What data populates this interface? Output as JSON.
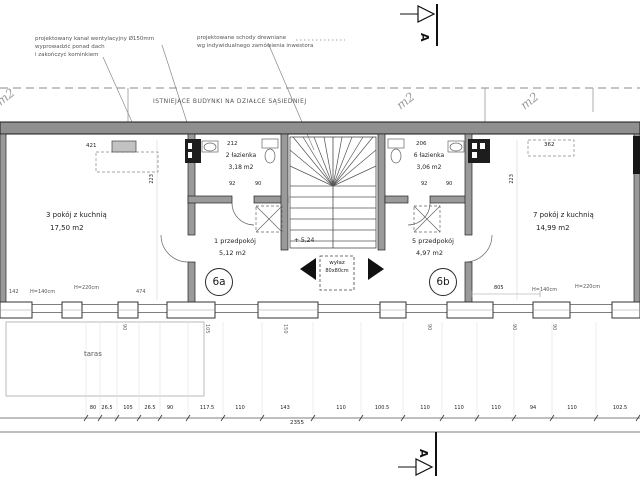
{
  "notes": {
    "vent_line1": "projektowany kanał wentylacyjny Ø150mm",
    "vent_line2": "wyprowadzić ponad dach",
    "vent_line3": "i zakończyć kominkiem",
    "stairs_line1": "projektowane schody drewniane",
    "stairs_line2": "wg indywidualnego zamówienia inwestora",
    "existing_buildings": "ISTNIEJĄCE BUDYNKI NA DZIAŁCE SĄSIEDNIEJ",
    "terrace": "taras",
    "hatch_line1": "wyłaz",
    "hatch_line2": "80x80cm",
    "level_marker": "+ 5,24",
    "plot_mark": "m2"
  },
  "section": {
    "letter": "A"
  },
  "units": {
    "a": "6a",
    "b": "6b"
  },
  "rooms": [
    {
      "name": "3 pokój z kuchnią",
      "area": "17,50 m2"
    },
    {
      "name": "2 łazienka",
      "area": "3,18 m2"
    },
    {
      "name": "1 przedpokój",
      "area": "5,12 m2"
    },
    {
      "name": "6 łazienka",
      "area": "3,06 m2"
    },
    {
      "name": "5 przedpokój",
      "area": "4,97 m2"
    },
    {
      "name": "7 pokój z kuchnią",
      "area": "14,99 m2"
    }
  ],
  "dims": {
    "room3_width": "421",
    "bath2_width": "212",
    "bath6_width": "206",
    "room7_width": "362",
    "depth_left": "223",
    "depth_right": "223",
    "door_left_a": "92",
    "door_left_b": "90",
    "door_right_a": "92",
    "door_right_b": "90",
    "hall_right": "805",
    "sill_142": "142",
    "h140_left": "H=140cm",
    "h220_left": "H=220cm",
    "seg_474": "474",
    "h140_right": "H=140cm",
    "h220_right": "H=220cm",
    "total": "2355",
    "chain": [
      "80",
      "26.5",
      "105",
      "26.5",
      "90",
      "117.5",
      "110",
      "143",
      "110",
      "100.5",
      "110",
      "110",
      "110",
      "94",
      "110",
      "102.5"
    ],
    "window_widths": [
      "90",
      "105",
      "150",
      "90",
      "90",
      "90"
    ]
  }
}
